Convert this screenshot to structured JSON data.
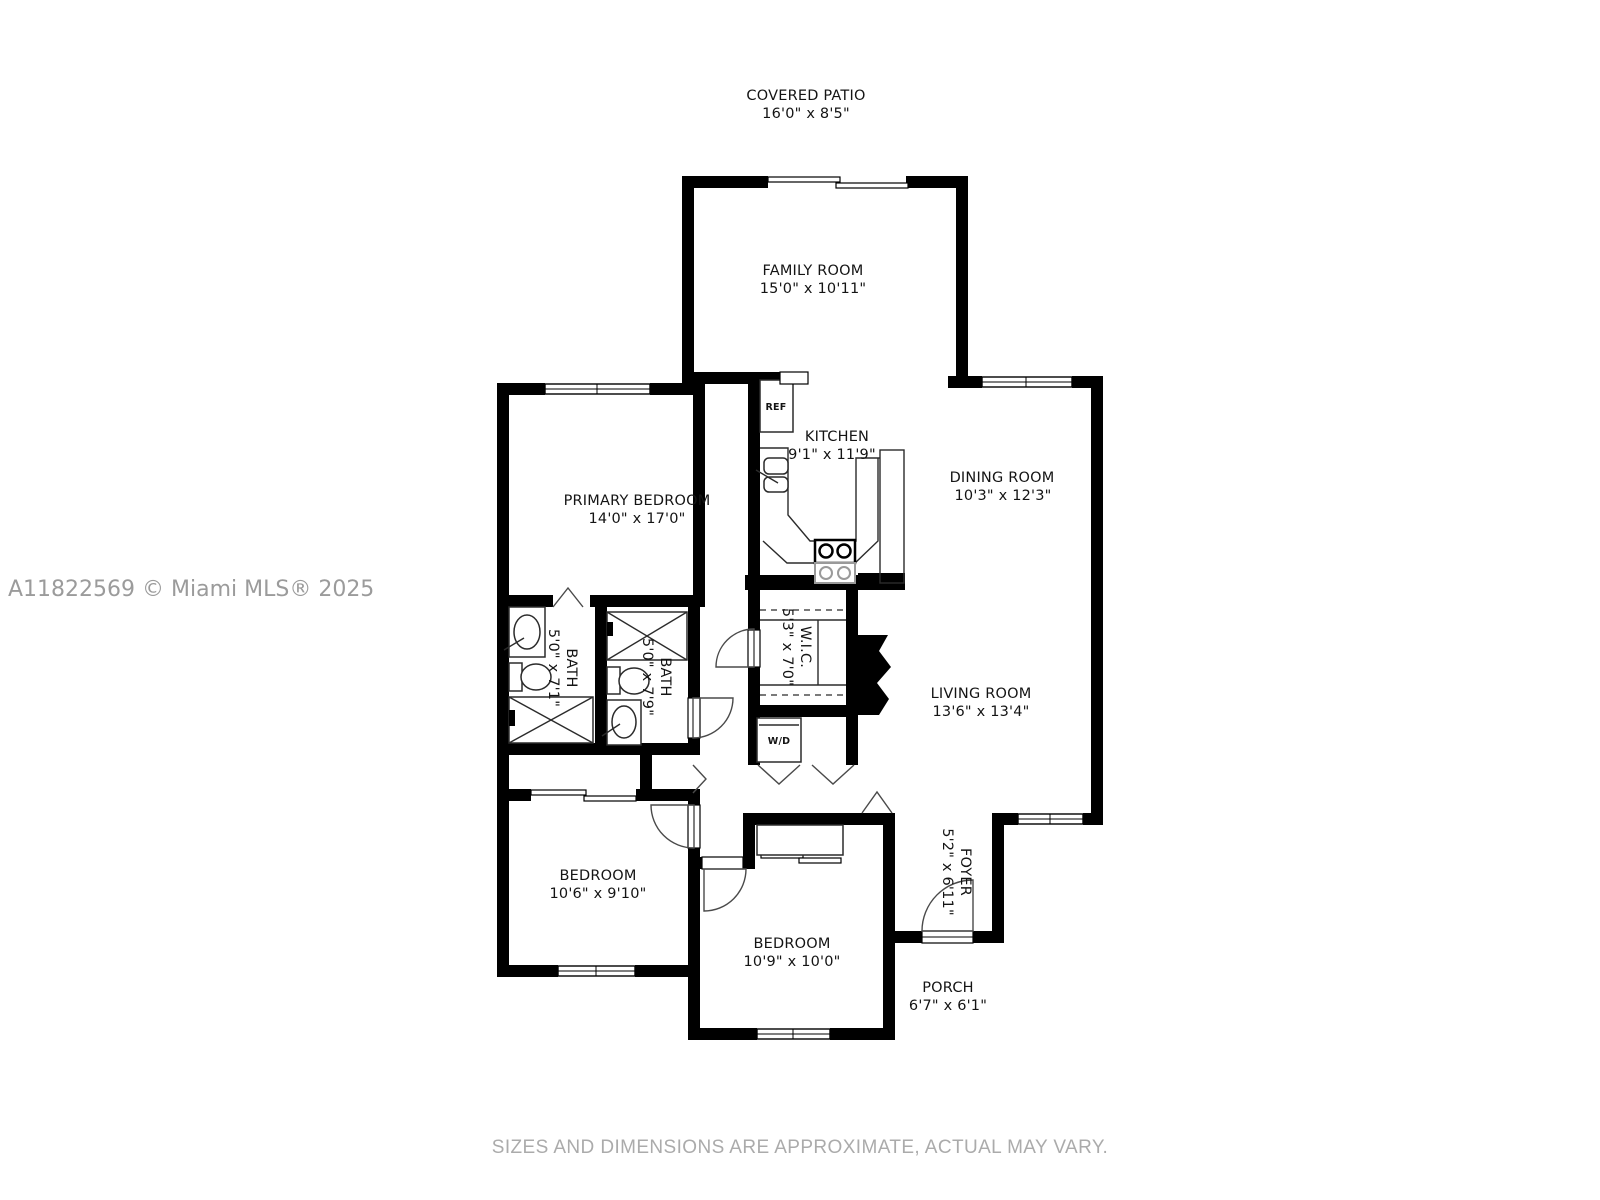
{
  "floor_plan": {
    "watermark": "A11822569 © Miami MLS® 2025",
    "disclaimer": "SIZES AND DIMENSIONS ARE APPROXIMATE, ACTUAL MAY VARY.",
    "wall_color": "#000000",
    "background_color": "#ffffff",
    "rooms": [
      {
        "name": "COVERED PATIO",
        "dims": "16'0\" x 8'5\""
      },
      {
        "name": "FAMILY ROOM",
        "dims": "15'0\" x 10'11\""
      },
      {
        "name": "KITCHEN",
        "dims": "9'1\" x 11'9\""
      },
      {
        "name": "DINING ROOM",
        "dims": "10'3\" x 12'3\""
      },
      {
        "name": "PRIMARY BEDROOM",
        "dims": "14'0\" x 17'0\""
      },
      {
        "name": "BATH",
        "dims": "5'0\" x 7'1\""
      },
      {
        "name": "BATH",
        "dims": "5'0\" x 7'9\""
      },
      {
        "name": "W.I.C.",
        "dims": "5'3\" x 7'0\""
      },
      {
        "name": "LIVING ROOM",
        "dims": "13'6\" x 13'4\""
      },
      {
        "name": "BEDROOM",
        "dims": "10'6\" x 9'10\""
      },
      {
        "name": "BEDROOM",
        "dims": "10'9\" x 10'0\""
      },
      {
        "name": "FOYER",
        "dims": "5'2\" x 6'11\""
      },
      {
        "name": "PORCH",
        "dims": "6'7\" x 6'1\""
      }
    ],
    "fixtures": {
      "refrigerator": "REF",
      "washer_dryer": "W/D"
    }
  }
}
